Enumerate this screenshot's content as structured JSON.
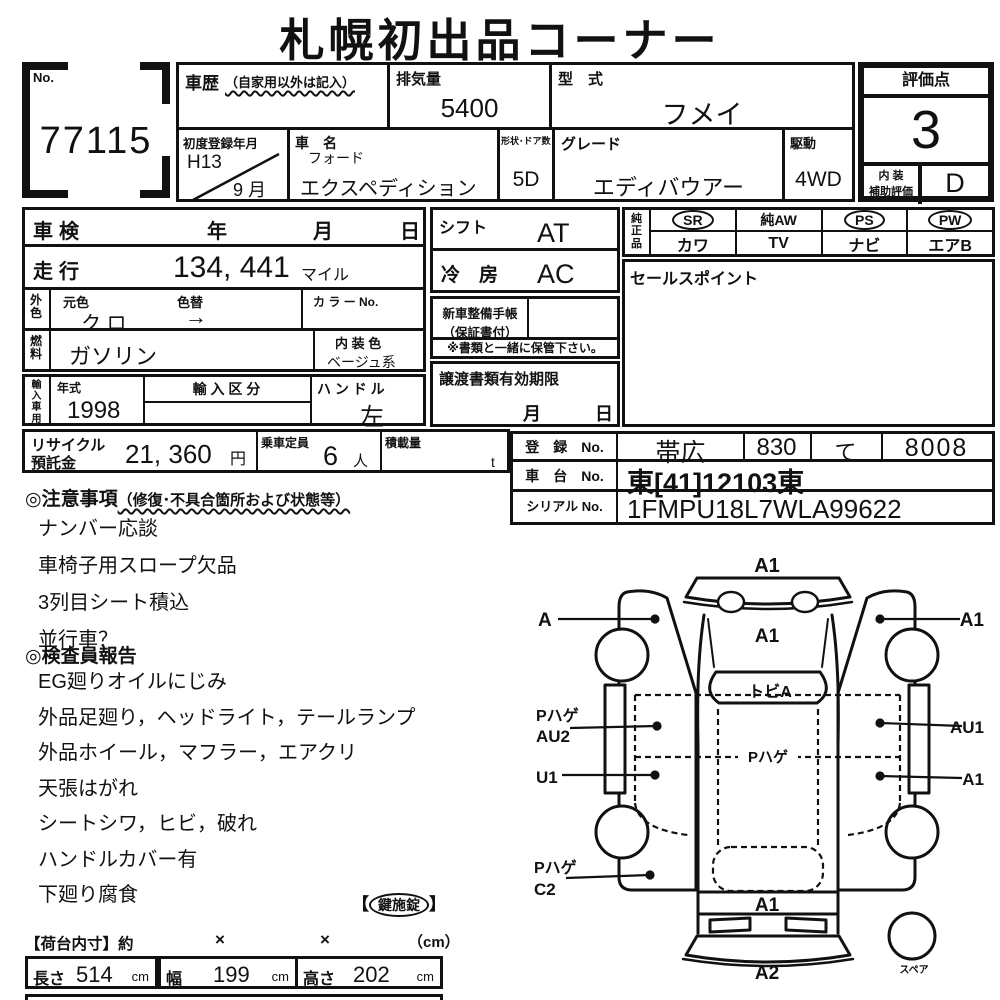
{
  "title": "札幌初出品コーナー",
  "lot": {
    "label": "No.",
    "number": "77115"
  },
  "top": {
    "history_label": "車歴",
    "history_note": "（自家用以外は記入）",
    "displacement_label": "排気量",
    "displacement": "5400",
    "model_code_label": "型　式",
    "model_code": "フメイ",
    "first_reg_label": "初度登録年月",
    "first_reg_year": "H13",
    "first_reg_month": "9 月",
    "car_name_label": "車　名",
    "maker": "フォード",
    "car_name": "エクスペディション",
    "doors_label": "形状･ドア数",
    "doors": "5D",
    "grade_label": "グレード",
    "grade": "エディバウアー",
    "drive_label": "駆動",
    "drive": "4WD"
  },
  "rating": {
    "label": "評価点",
    "score": "3",
    "interior_label_1": "内 装",
    "interior_label_2": "補助評価",
    "interior_score": "D"
  },
  "left": {
    "shaken": {
      "label": "車検",
      "year": "年",
      "month": "月",
      "day": "日"
    },
    "mileage": {
      "label": "走行",
      "value": "134, 441",
      "unit": "マイル"
    },
    "color": {
      "label_v": "外色",
      "orig_label": "元色",
      "orig": "ク ロ",
      "change_label": "色替",
      "change": "→",
      "colorno_label": "カ ラ ー No."
    },
    "fuel": {
      "label_v": "燃料",
      "value": "ガソリン",
      "interior_label": "内 装 色",
      "interior": "ベージュ系"
    },
    "import": {
      "label_v": "輸入車用",
      "year_label": "年式",
      "year": "1998",
      "class_label": "輸 入 区 分",
      "handle_label": "ハ ン ド ル",
      "handle": "左"
    },
    "recycle": {
      "label1": "リサイクル",
      "label2": "預託金",
      "value": "21, 360",
      "unit": "円",
      "capacity_label": "乗車定員",
      "capacity": "6",
      "capacity_unit": "人",
      "load_label": "積載量",
      "load_unit": "t"
    }
  },
  "middle": {
    "shift": {
      "label": "シフト",
      "value": "AT"
    },
    "ac": {
      "label": "冷　房",
      "value": "AC"
    },
    "manual": {
      "line1": "新車整備手帳",
      "line2": "（保証書付）"
    },
    "keep_note": "※書類と一緒に保管下さい。",
    "transfer": {
      "label": "譲渡書類有効期限",
      "month": "月",
      "day": "日"
    }
  },
  "equipment": {
    "label_v": "純正品",
    "row1": [
      {
        "label": "SR",
        "circled": true
      },
      {
        "label": "純AW",
        "circled": false
      },
      {
        "label": "PS",
        "circled": true
      },
      {
        "label": "PW",
        "circled": true
      }
    ],
    "row2": [
      "カワ",
      "TV",
      "ナビ",
      "エアB"
    ]
  },
  "sales_point": {
    "label": "セールスポイント"
  },
  "registration": {
    "reg_label": "登　録　No.",
    "reg_area": "帯広",
    "reg_class": "830",
    "reg_kana": "て",
    "reg_num": "8008",
    "chassis_label": "車　台　No.",
    "chassis": "東[41]12103東",
    "serial_label": "シリアル No.",
    "serial": "1FMPU18L7WLA99622"
  },
  "notes": {
    "heading": "◎注意事項",
    "heading_note": "（修復･不具合箇所および状態等）",
    "items": [
      "ナンバー応談",
      "車椅子用スロープ欠品",
      "3列目シート積込",
      "並行車？"
    ]
  },
  "inspector": {
    "heading": "◎検査員報告",
    "items": [
      "EG廻りオイルにじみ",
      "外品足廻り，ヘッドライト，テールランプ",
      "外品ホイール，マフラー，エアクリ",
      "天張はがれ",
      "シートシワ，ヒビ，破れ",
      "ハンドルカバー有",
      "下廻り腐食"
    ],
    "key_open": "【",
    "key_text": "鍵施錠",
    "key_close": "】"
  },
  "cargo": {
    "heading": "【荷台内寸】約",
    "x1": "×",
    "x2": "×",
    "unit": "（cm）",
    "cells": [
      {
        "label": "長さ",
        "value": "514",
        "unit": "cm"
      },
      {
        "label": "幅",
        "value": "199",
        "unit": "cm"
      },
      {
        "label": "高さ",
        "value": "202",
        "unit": "cm"
      }
    ]
  },
  "diagram": {
    "front_bumper": "A1",
    "left_front": "A",
    "right_front": "A1",
    "hood": "A1",
    "windshield": "トビA",
    "left_mid_1": "Pハゲ",
    "left_mid_2": "AU2",
    "right_mid": "AU1",
    "roof": "Pハゲ",
    "left_lower": "U1",
    "right_lower": "A1",
    "left_rear_1": "Pハゲ",
    "left_rear_2": "C2",
    "tailgate": "A1",
    "rear_bumper": "A2",
    "spare": "スペア"
  }
}
